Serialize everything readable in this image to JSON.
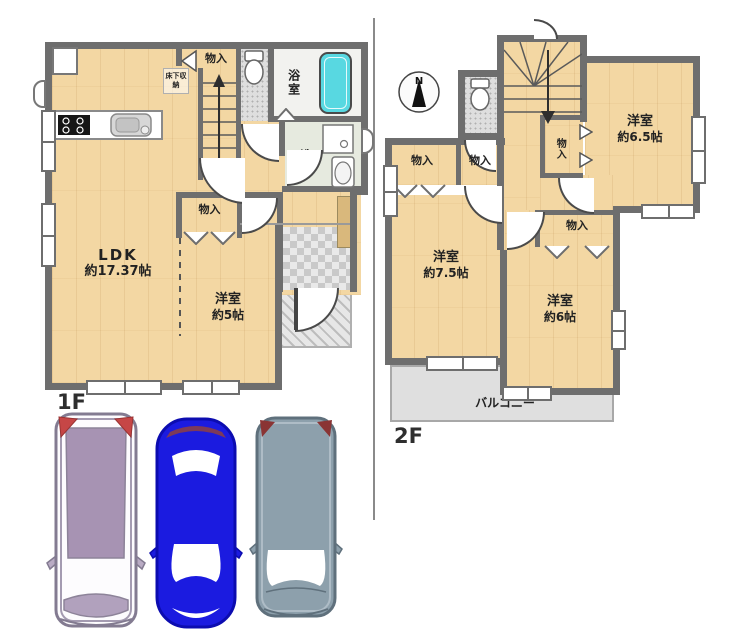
{
  "floor1": {
    "tag": "1F",
    "ldk": {
      "name": "LDK",
      "size": "約17.37帖"
    },
    "bedroom": {
      "name": "洋室",
      "size": "約5帖"
    },
    "bath": {
      "label": "浴室"
    },
    "washroom": {
      "label": "洗面"
    },
    "closet_top": {
      "label": "物入"
    },
    "closet_mid": {
      "label": "物入"
    },
    "underfloor_storage": {
      "label": "床下収納"
    }
  },
  "floor2": {
    "tag": "2F",
    "bedroom_65": {
      "name": "洋室",
      "size": "約6.5帖"
    },
    "bedroom_75": {
      "name": "洋室",
      "size": "約7.5帖"
    },
    "bedroom_6": {
      "name": "洋室",
      "size": "約6帖"
    },
    "closet_left_a": {
      "label": "物入"
    },
    "closet_left_b": {
      "label": "物入"
    },
    "closet_center": {
      "label": "物入"
    },
    "closet_right": {
      "label": "物入"
    },
    "balcony": {
      "label": "バルコニー"
    },
    "compass": {
      "label": "N"
    }
  },
  "colors": {
    "wood_floor": "#f3d7a3",
    "wall": "#6e6e6e",
    "bathtub_cyan": "#58d8e1",
    "balcony_gray": "#dfdfdf",
    "tile_gray": "#dedede",
    "car_minivan_purple": "#a793b3",
    "car_sedan_blue": "#1b1be0",
    "car_wagon_slate": "#8da0ac"
  }
}
